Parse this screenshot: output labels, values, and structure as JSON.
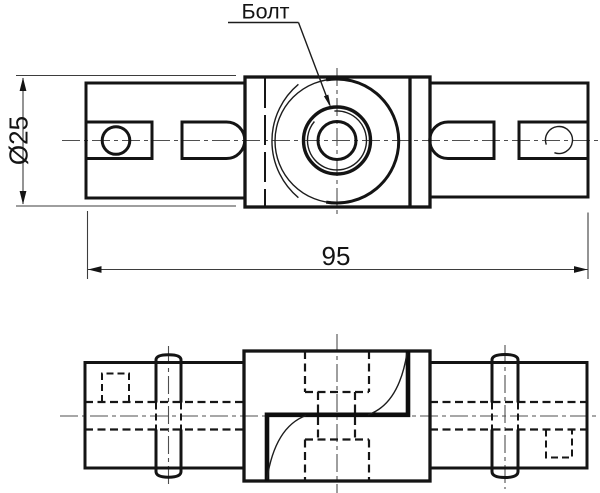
{
  "drawing": {
    "callout": {
      "text": "Болт"
    },
    "dimensions": {
      "diameter": "Ø25",
      "length": "95"
    },
    "colors": {
      "line": "#141414",
      "thin_line": "#3d3d3d",
      "centerline": "#4f4f4f",
      "background": "#ffffff"
    }
  }
}
